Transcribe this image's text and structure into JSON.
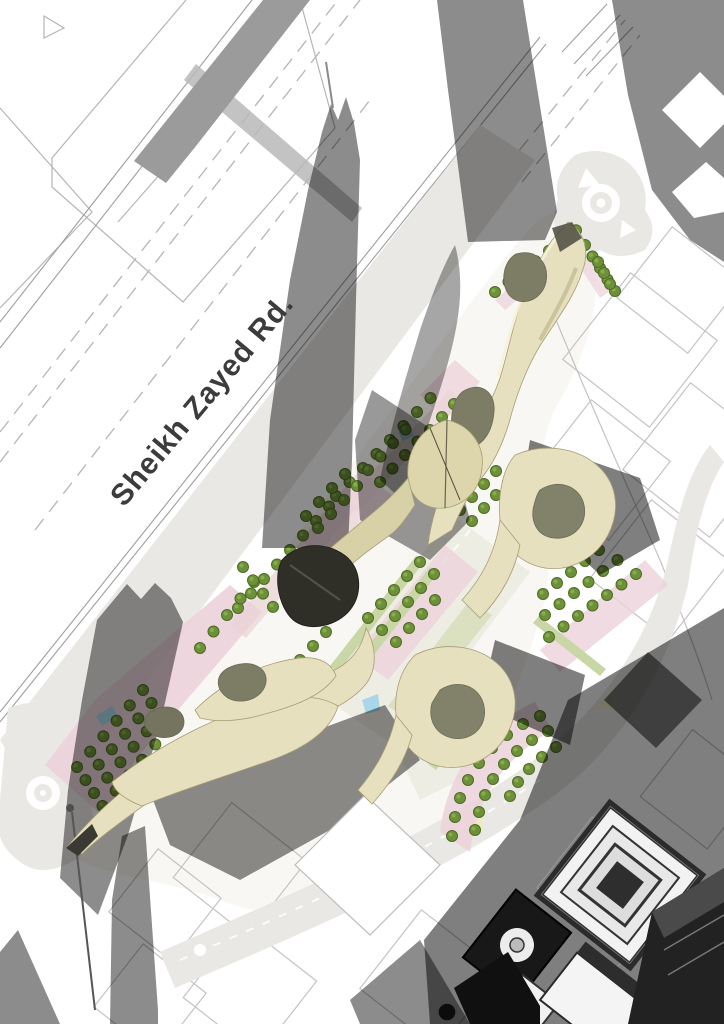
{
  "title": "Aerial architectural site plan rendering",
  "road": {
    "label": "Sheikh Zayed Rd."
  },
  "colors": {
    "background": "#ffffff",
    "building_cream": "#e7e0be",
    "building_cream_shade": "#cfc69c",
    "courtyard_olive": "#7d7d66",
    "tower_dark": "#2f2f28",
    "tree_green": "#6d9138",
    "tree_green_dark": "#4e6b26",
    "paving_pink": "#ecd2db",
    "lawn_green": "#c9d6a6",
    "road_light_gray": "#e9e8e4",
    "shadow_gray": "#8c8c8c",
    "water_blue": "#a9d6e8",
    "label_text": "#3c3c3c",
    "lot_line": "#bdbdbd"
  },
  "features": [
    "highway",
    "service-road",
    "roundabout",
    "mini-roundabout",
    "tree-grid",
    "tree-crescent",
    "tower-shadows",
    "organic-buildings",
    "courtyard-voids",
    "city-block-outlines",
    "existing-buildings"
  ],
  "landscape": {
    "tree_rows": [
      [
        238,
        608,
        13,
        -14.5,
        8
      ],
      [
        336,
        496,
        13.5,
        -14,
        8
      ],
      [
        495,
        292,
        13.5,
        -10.3,
        7
      ],
      [
        585,
        245,
        7.5,
        11.5,
        5
      ],
      [
        598,
        262,
        6,
        11,
        3
      ],
      [
        77,
        767,
        13.2,
        -15.4,
        6
      ],
      [
        85.5,
        780,
        13.2,
        -15.4,
        6
      ],
      [
        94,
        793,
        13.2,
        -15.4,
        6
      ],
      [
        102.5,
        806,
        13.2,
        -15.4,
        6
      ],
      [
        111,
        819,
        13.2,
        -15.4,
        5
      ],
      [
        200,
        648,
        13.5,
        -16.5,
        5
      ],
      [
        243,
        567,
        10,
        13.3,
        4
      ],
      [
        306,
        516,
        13,
        -14,
        4
      ],
      [
        318,
        528,
        13,
        -14,
        4
      ],
      [
        368,
        470,
        12.5,
        -13.5,
        4
      ],
      [
        380,
        482,
        12.5,
        -13.5,
        4
      ],
      [
        430,
        430,
        12,
        -13,
        3
      ],
      [
        442,
        442,
        12,
        -13,
        3
      ],
      [
        460,
        510,
        12,
        -13,
        4
      ],
      [
        472,
        521,
        12,
        -13,
        4
      ],
      [
        368,
        618,
        13,
        -14,
        5
      ],
      [
        382,
        630,
        13,
        -14,
        5
      ],
      [
        396,
        642,
        13,
        -14,
        4
      ],
      [
        300,
        660,
        13,
        -14,
        3
      ],
      [
        549,
        637,
        14.5,
        -10.5,
        7
      ],
      [
        545,
        615,
        14.5,
        -11,
        6
      ],
      [
        543,
        594,
        14,
        -11,
        5
      ]
    ],
    "tree_points": [
      [
        540,
        716
      ],
      [
        523,
        724
      ],
      [
        507,
        735
      ],
      [
        492,
        748
      ],
      [
        479,
        763
      ],
      [
        468,
        780
      ],
      [
        460,
        798
      ],
      [
        455,
        817
      ],
      [
        452,
        836
      ],
      [
        548,
        731
      ],
      [
        532,
        740
      ],
      [
        517,
        751
      ],
      [
        504,
        764
      ],
      [
        493,
        779
      ],
      [
        485,
        795
      ],
      [
        479,
        812
      ],
      [
        475,
        830
      ],
      [
        556,
        747
      ],
      [
        542,
        757
      ],
      [
        529,
        769
      ],
      [
        518,
        782
      ],
      [
        510,
        796
      ]
    ]
  }
}
